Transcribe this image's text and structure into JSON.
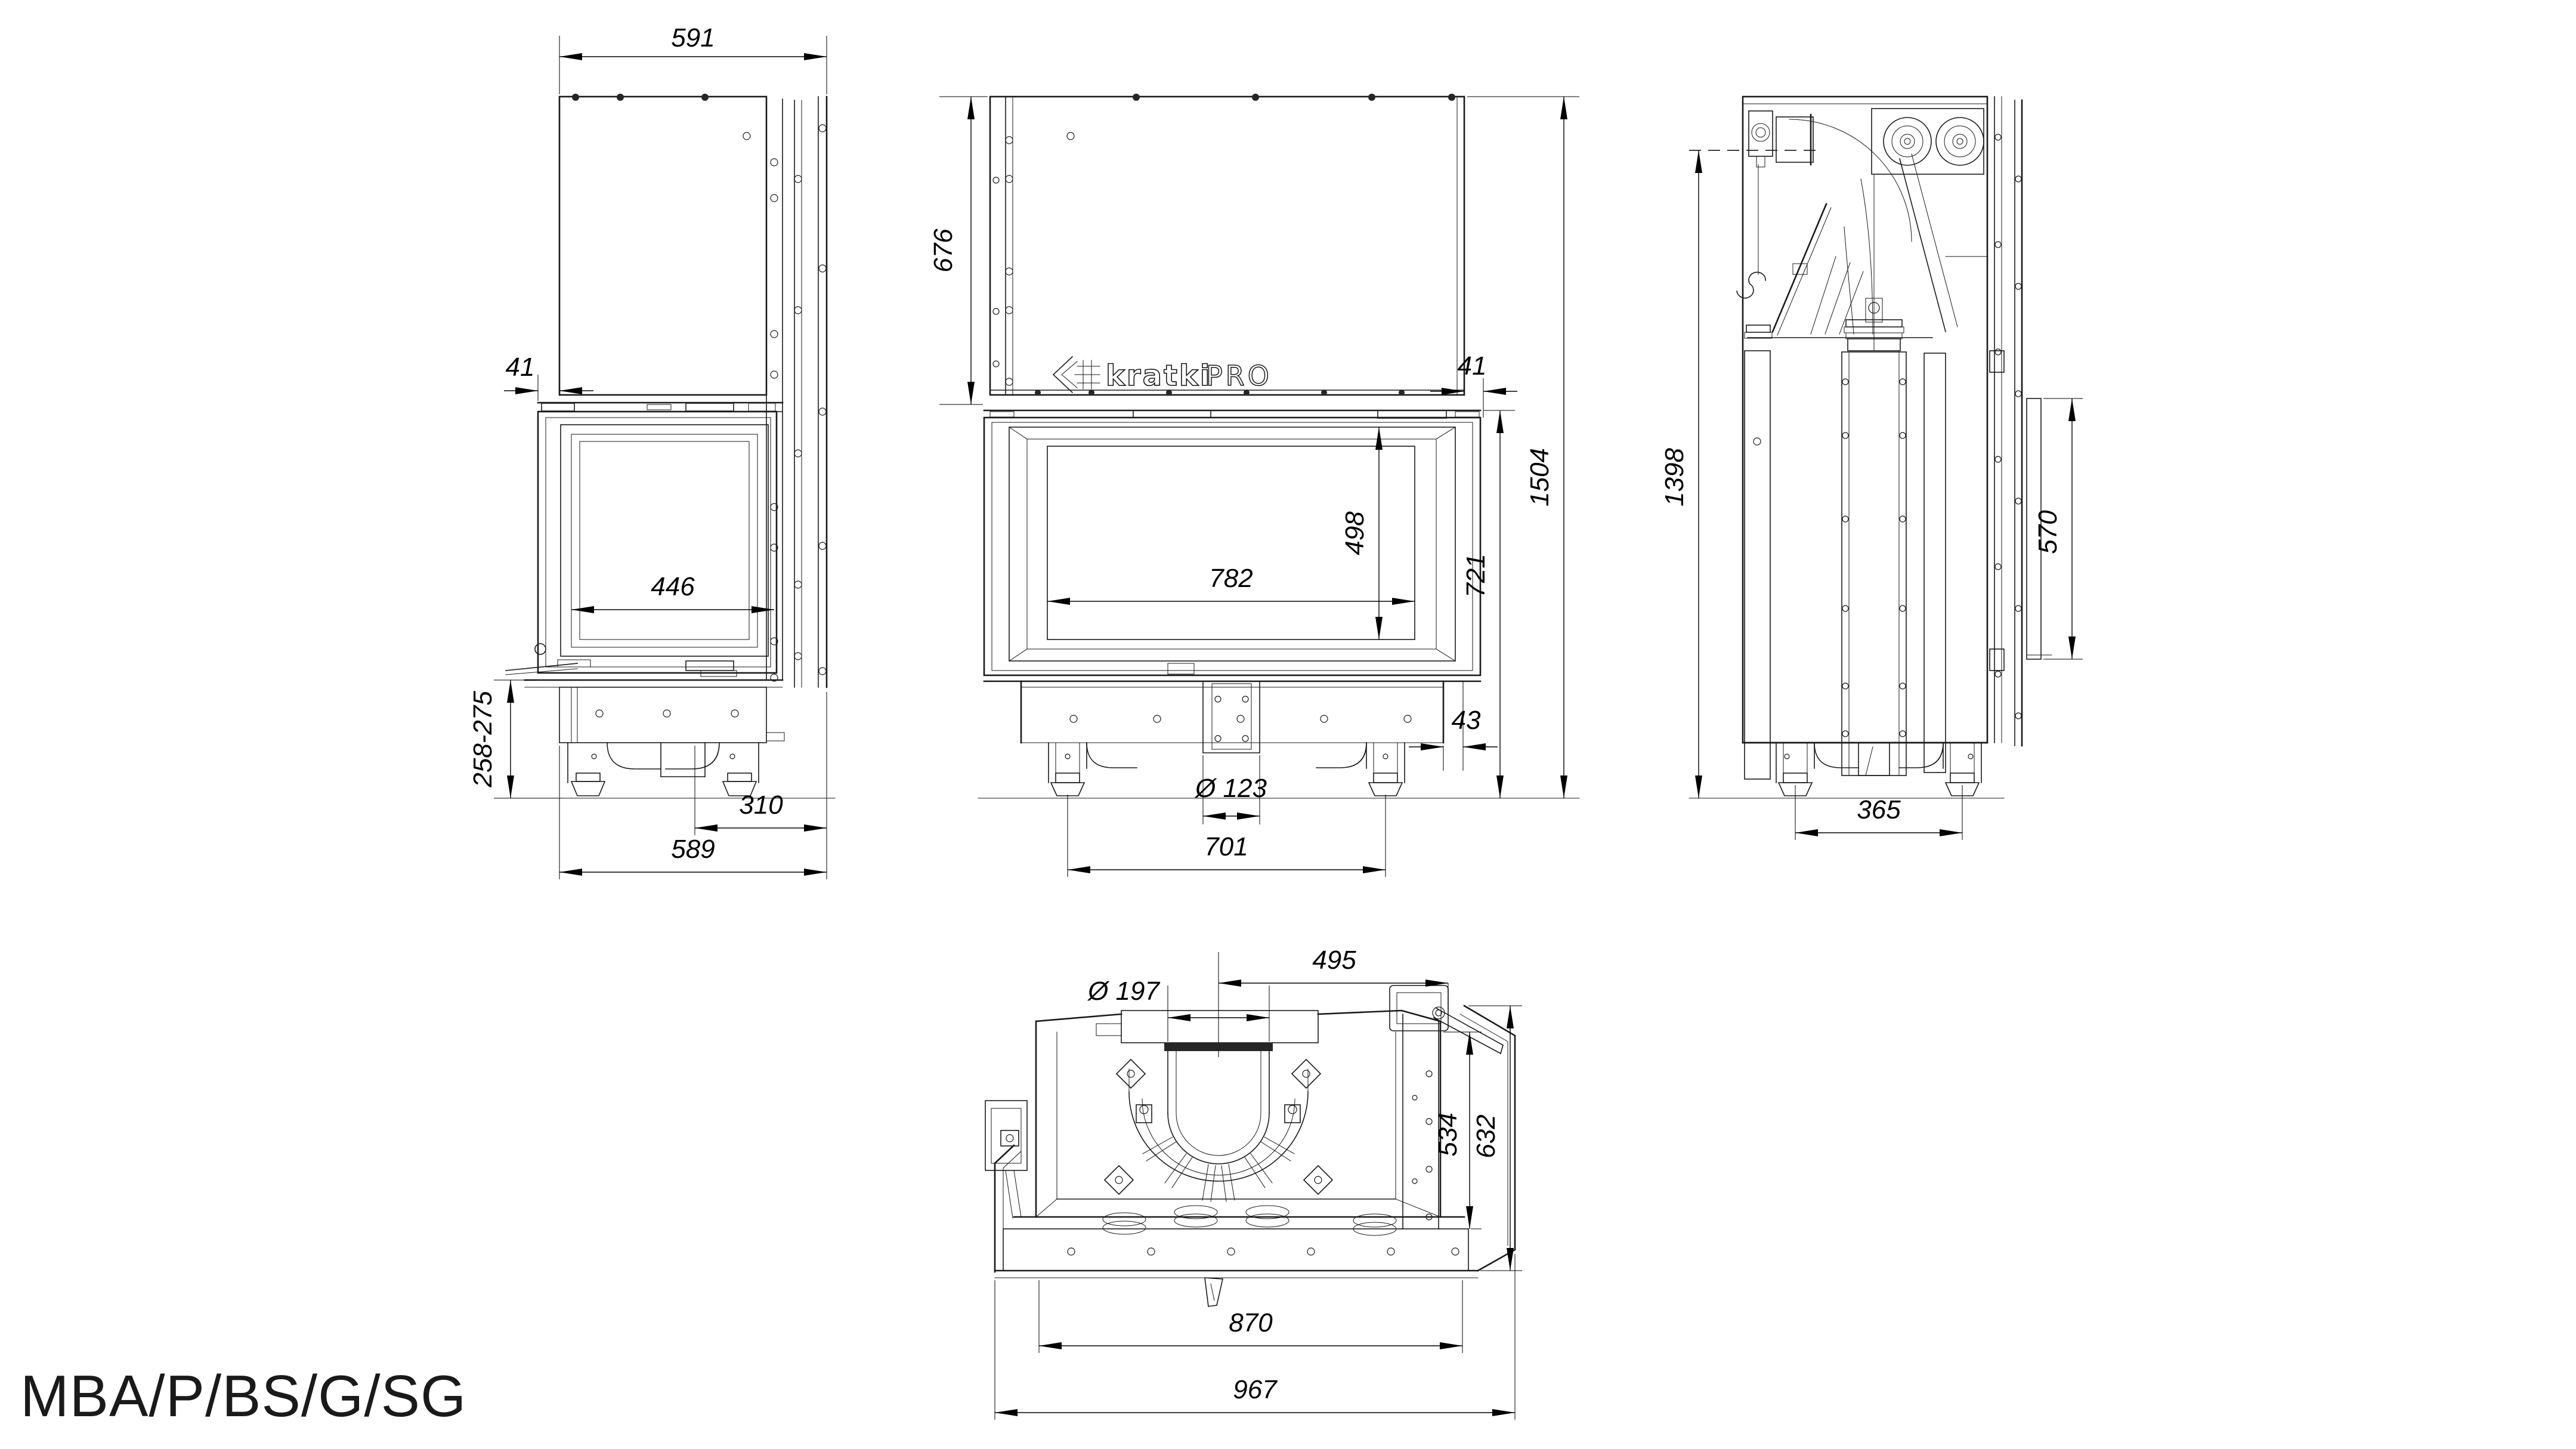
{
  "page": {
    "background": "#ffffff",
    "caption": "MBA/P/BS/G/SG"
  },
  "logo": {
    "brand": "kratki",
    "series": "PRO"
  },
  "views": {
    "side_left": {
      "title": "left side view",
      "dims": {
        "overall_width": "591",
        "frame_offset": "41",
        "glass_width": "446",
        "plinth_height": "258-275",
        "foot_to_frame": "310",
        "base_width": "589"
      }
    },
    "front": {
      "title": "front view",
      "dims": {
        "hood_height": "676",
        "frame_offset": "41",
        "glass_width": "782",
        "glass_height": "498",
        "firebox_height": "721",
        "overall_height": "1504",
        "frame_gap": "43",
        "outlet_diameter": "Ø 123",
        "feet_spacing": "701"
      }
    },
    "side_right": {
      "title": "right section view",
      "dims": {
        "flue_axis_height": "1398",
        "rear_shield_height": "570",
        "feet_spacing": "365"
      }
    },
    "top": {
      "title": "top view",
      "dims": {
        "flue_center_to_edge": "495",
        "flue_diameter": "Ø 197",
        "body_depth": "534",
        "overall_depth": "632",
        "body_width": "870",
        "overall_width": "967"
      }
    }
  }
}
